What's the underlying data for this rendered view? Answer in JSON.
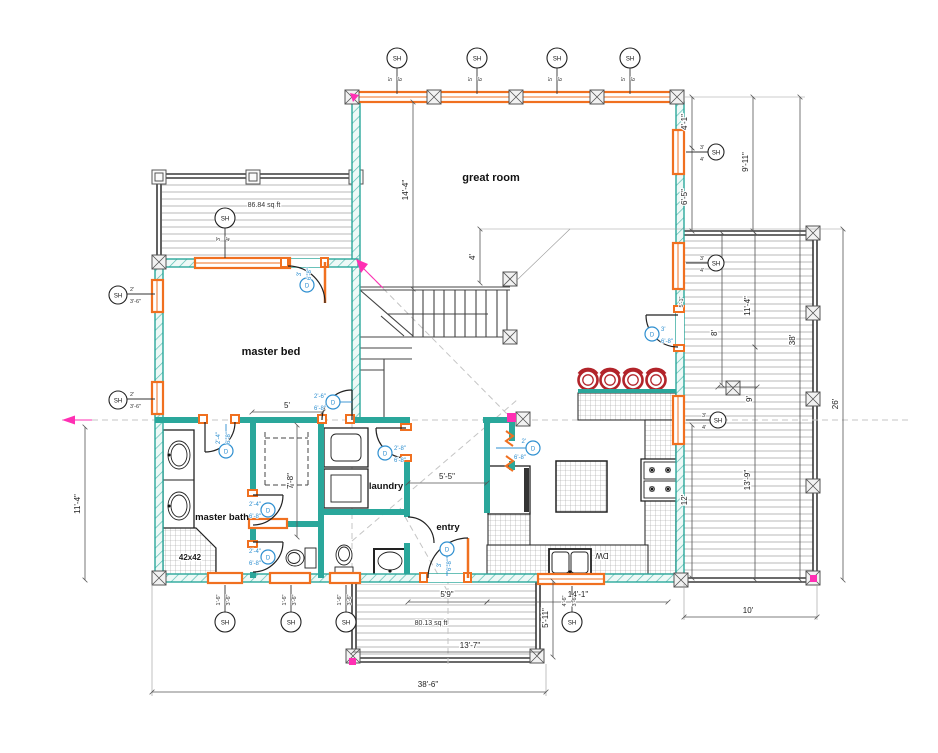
{
  "colors": {
    "wall_teal": "#2aa79b",
    "window_orange": "#f07020",
    "door_tag_blue": "#2e8fd0",
    "marker_magenta": "#ff2fb3",
    "stool_red": "#b2242a",
    "deck_gray": "#9b9b9b"
  },
  "rooms": {
    "great_room": "great room",
    "master_bed": "master bed",
    "master_bath": "master bath",
    "laundry": "laundry",
    "entry": "entry"
  },
  "areas": {
    "upper_deck_sqft": "86.84 sq ft",
    "lower_deck_sqft": "80.13 sq ft",
    "shower_size": "42x42"
  },
  "appliances": {
    "dishwasher": "DW"
  },
  "dims": {
    "great_room_height": "14'-4\"",
    "landing": "4'",
    "closet_width": "5'",
    "closet_depth": "7'-8\"",
    "entry_width": "5'-5\"",
    "right_top_a": "4'-1\"",
    "right_top_b": "6'-5\"",
    "right_porch": "9'-11\"",
    "right_total": "38'",
    "deck_total": "26'",
    "deck_upper": "11'-4\"",
    "deck_lower": "13'-9\"",
    "deck_a": "8'",
    "deck_b": "9'",
    "deck_c": "12'",
    "deck_width": "10'",
    "deck_small": "5'-1\"",
    "bath_height": "11'-4\"",
    "entry_bottom": "5'9\"",
    "kitchen_bottom": "14'-1\"",
    "lower_deck_width": "13'-7\"",
    "lower_deck_height": "5'-11\"",
    "house_width": "38'-6\""
  },
  "tags": {
    "sh": "SH",
    "d": "D",
    "win": {
      "top": [
        "5'",
        "6'"
      ],
      "deck": [
        "3'",
        "4'"
      ],
      "side": [
        "3'",
        "4'"
      ],
      "left": [
        "2'",
        "3'-6\""
      ],
      "bottom": [
        "1'-6\"",
        "3'-6\""
      ],
      "kitchen": [
        "4'-6\"",
        "3'-6\""
      ]
    },
    "door": {
      "d3": [
        "3'",
        "6'-8\""
      ],
      "d2_6": [
        "2'-6\"",
        "6'-8\""
      ],
      "d2_8": [
        "2'-8\"",
        "6'-8\""
      ],
      "d2_4": [
        "2'-4\"",
        "6'-8\""
      ],
      "d2": [
        "2'",
        "6'-8\""
      ]
    }
  }
}
